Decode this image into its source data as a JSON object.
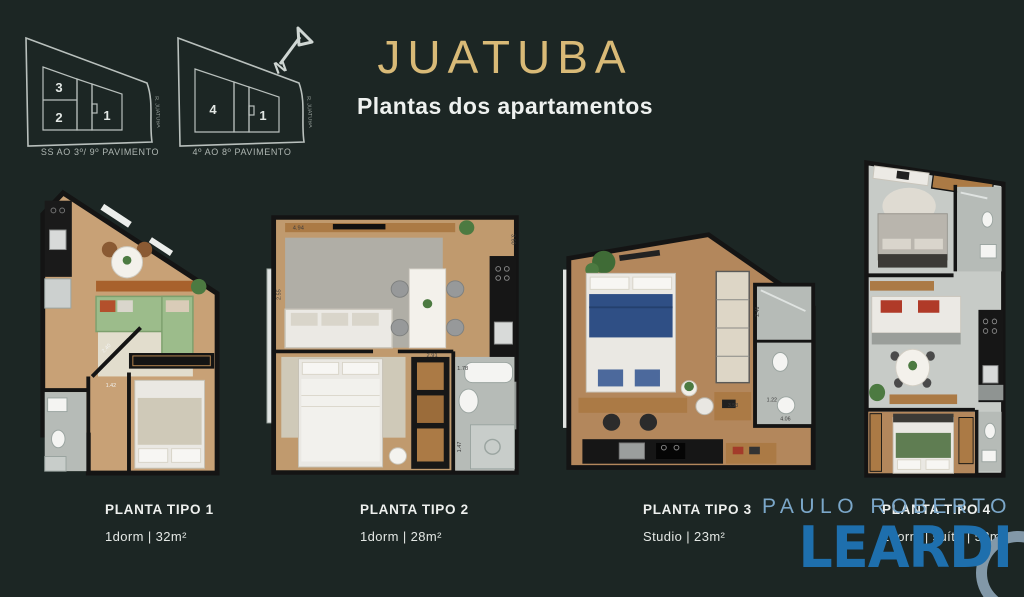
{
  "colors": {
    "background": "#1c2624",
    "title_gold": "#d9ba77",
    "leardi_blue": "#1e6fad",
    "leardi_light_blue": "#7ba7c9"
  },
  "header": {
    "title": "JUATUBA",
    "subtitle": "Plantas dos apartamentos"
  },
  "north_label": "N",
  "keyplans": [
    {
      "caption": "SS AO 3º/ 9º PAVIMENTO",
      "street": "R. JUATUBA",
      "units": [
        "3",
        "2",
        "1"
      ]
    },
    {
      "caption": "4º AO 8º PAVIMENTO",
      "street": "R. JUATUBA",
      "units": [
        "4",
        "1"
      ]
    }
  ],
  "plans": [
    {
      "name": "PLANTA TIPO 1",
      "details": "1dorm | 32m²",
      "measurements": [
        "2.40",
        "1.42"
      ]
    },
    {
      "name": "PLANTA TIPO 2",
      "details": "1dorm | 28m²",
      "measurements": [
        "4.94",
        "3.60",
        "2.55",
        "2.91",
        "1.78",
        "1.47"
      ]
    },
    {
      "name": "PLANTA TIPO 3",
      "details": "Studio | 23m²",
      "measurements": [
        "2.46",
        "1.22",
        "3.53",
        "4.06"
      ]
    },
    {
      "name": "PLANTA TIPO 4",
      "details": "2dorm | suíte | 52m²",
      "measurements": []
    }
  ],
  "watermark": {
    "line1": "PAULO ROBERTO",
    "line2": "LEARDI"
  }
}
